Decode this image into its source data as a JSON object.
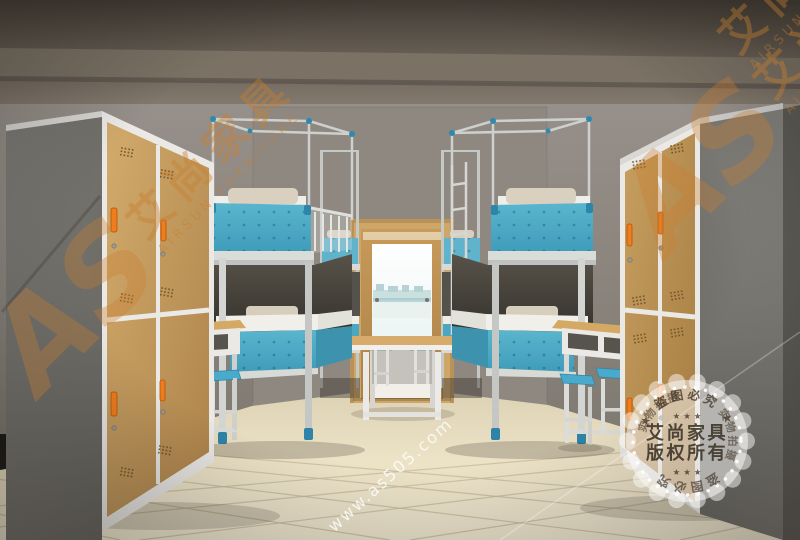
{
  "meta": {
    "type": "furniture-showroom-render",
    "description": "3D render of a dormitory room: wood-door steel lockers left and right, two rows of steel bunk beds with teal perforated panels, study desks with shelves, blue stools, open double door with bright window at the end, beige tiled floor",
    "width": 800,
    "height": 540
  },
  "watermark": {
    "logo": "AS",
    "brand_cn": "艾尚家具",
    "brand_en": "AIRSUN FURNITURE",
    "url": "www.as505.com"
  },
  "stamp": {
    "center_line1": "艾尚家具",
    "center_line2": "版权所有",
    "arc_top": "★ 盗图必究 ★",
    "arc_bottom": "盗图必究",
    "arc_left": "实物拍摄",
    "arc_right": "实物拍摄",
    "stars_top": "★ ★ ★",
    "stars_bottom": "★ ★ ★"
  },
  "scene": {
    "objects": [
      "locker-left",
      "locker-right",
      "bunk-bed-left-near",
      "bunk-bed-left-far",
      "bunk-bed-right-near",
      "bunk-bed-right-far",
      "desk-left",
      "desk-right",
      "center-desk",
      "stools",
      "door",
      "window-view",
      "tiled-floor"
    ],
    "colors": {
      "wall": "#8e8881",
      "ceiling": "#5a544c",
      "floor": "#efe6cc",
      "wood": "#c49a5c",
      "frame_white": "#eae9e5",
      "panel_teal": "#4aa7c2",
      "handle_orange": "#f07d1c",
      "stool_blue": "#49aacb",
      "watermark_orange": "#c97f2e",
      "stamp_text": "#4a3f33"
    }
  }
}
